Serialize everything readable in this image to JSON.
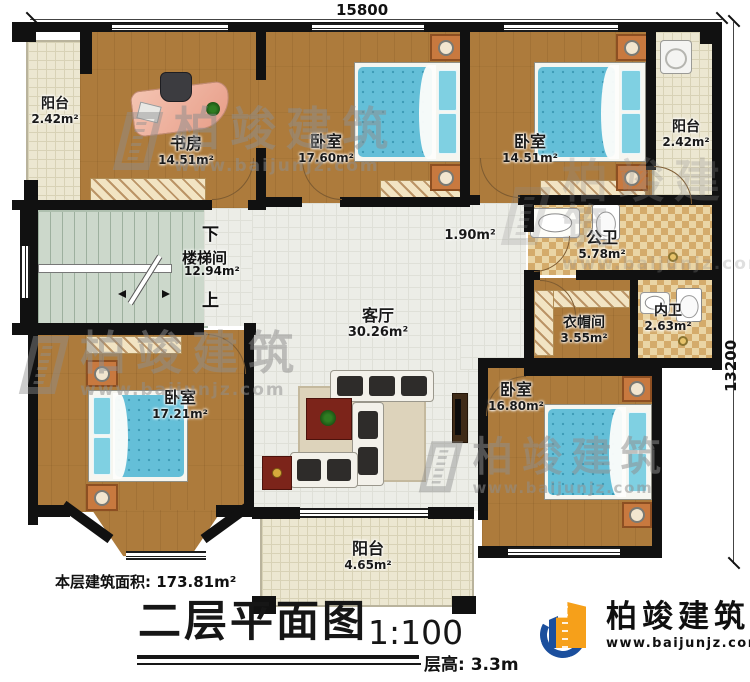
{
  "dimensions": {
    "width": "15800",
    "height": "13200"
  },
  "rooms": [
    {
      "id": "balcony-top-left",
      "name": "阳台",
      "area": "2.42m²"
    },
    {
      "id": "study",
      "name": "书房",
      "area": "14.51m²"
    },
    {
      "id": "bedroom-top-middle",
      "name": "卧室",
      "area": "17.60m²"
    },
    {
      "id": "bedroom-top-right",
      "name": "卧室",
      "area": "14.51m²"
    },
    {
      "id": "balcony-top-right",
      "name": "阳台",
      "area": "2.42m²"
    },
    {
      "id": "stairwell",
      "name": "楼梯间",
      "area": "12.94m²"
    },
    {
      "id": "hallway",
      "name": "",
      "area": "1.90m²"
    },
    {
      "id": "public-bathroom",
      "name": "公卫",
      "area": "5.78m²"
    },
    {
      "id": "cloakroom",
      "name": "衣帽间",
      "area": "3.55m²"
    },
    {
      "id": "ensuite-bathroom",
      "name": "内卫",
      "area": "2.63m²"
    },
    {
      "id": "living-room",
      "name": "客厅",
      "area": "30.26m²"
    },
    {
      "id": "bedroom-bottom-left",
      "name": "卧室",
      "area": "17.21m²"
    },
    {
      "id": "bedroom-bottom-right",
      "name": "卧室",
      "area": "16.80m²"
    },
    {
      "id": "balcony-bottom",
      "name": "阳台",
      "area": "4.65m²"
    }
  ],
  "stair_markers": {
    "down": "下",
    "up": "上"
  },
  "footer": {
    "floor_area": "本层建筑面积: 173.81m²",
    "title": "二层平面图",
    "scale": "1:100",
    "floor_height": "层高: 3.3m"
  },
  "brand": {
    "name": "柏竣建筑",
    "site": "www.baijunjz.com"
  },
  "watermark": {
    "name": "柏竣建筑",
    "site": "www.baijunjz.com"
  },
  "colors": {
    "wall": "#111111",
    "wood": "#ad7b3c",
    "bed": "#64bfd8",
    "balcony": "#ece7d1",
    "tileA": "#ead5a5",
    "tileB": "#d4ab6b",
    "stair": "#ccd8cb",
    "logoBlue": "#1b4f9d",
    "logoOrange": "#f6a01a"
  }
}
